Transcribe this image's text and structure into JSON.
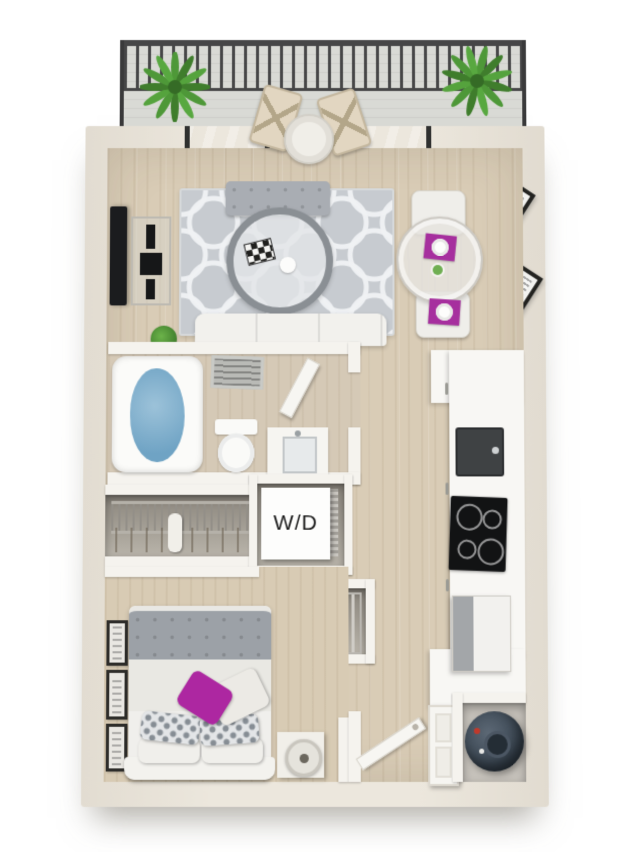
{
  "labels": {
    "washer_dryer": "W/D"
  },
  "palette": {
    "background": "#ffffff",
    "outer_wall": "#e9e3d9",
    "inner_wall": "#f5f3ee",
    "wood_floor": "#d8cbb4",
    "rug_gray": "#c7cbd0",
    "railing_black": "#3a3a3b",
    "plant_green": "#4f9a3a",
    "accent_magenta": "#a62f9e",
    "pillow_magenta": "#ad27a1",
    "tub_water_blue": "#7fb0cd",
    "appliance_black": "#141516",
    "stainless_steel": "#a3a6a9",
    "water_heater_slate": "#3e4a56"
  },
  "scene_objects": [
    "balcony",
    "balcony-railing",
    "potted-plant",
    "bistro-chair",
    "bistro-table",
    "sliding-glass-door",
    "curtain-rod",
    "curtain",
    "wall-tv",
    "media-console",
    "area-rug",
    "accent-bench",
    "coffee-table",
    "checkered-board",
    "sofa",
    "floor-plant",
    "dining-table",
    "dining-chair",
    "placemat",
    "dinner-plate",
    "flower-vase",
    "wall-art",
    "bathtub",
    "ceiling-vent",
    "bathroom-door",
    "toilet",
    "vanity-sink",
    "wardrobe-closet",
    "wire-shelf",
    "hanging-clothes",
    "washer-dryer",
    "louver-door",
    "linen-closet",
    "kitchen-counter",
    "kitchen-sink",
    "cooktop",
    "refrigerator",
    "cabinet-handle",
    "bed",
    "duvet",
    "pillow",
    "accent-pillow",
    "headboard",
    "nightstand",
    "table-lamp",
    "picture-frame",
    "entry-door",
    "door-panel",
    "utility-closet",
    "water-heater"
  ]
}
